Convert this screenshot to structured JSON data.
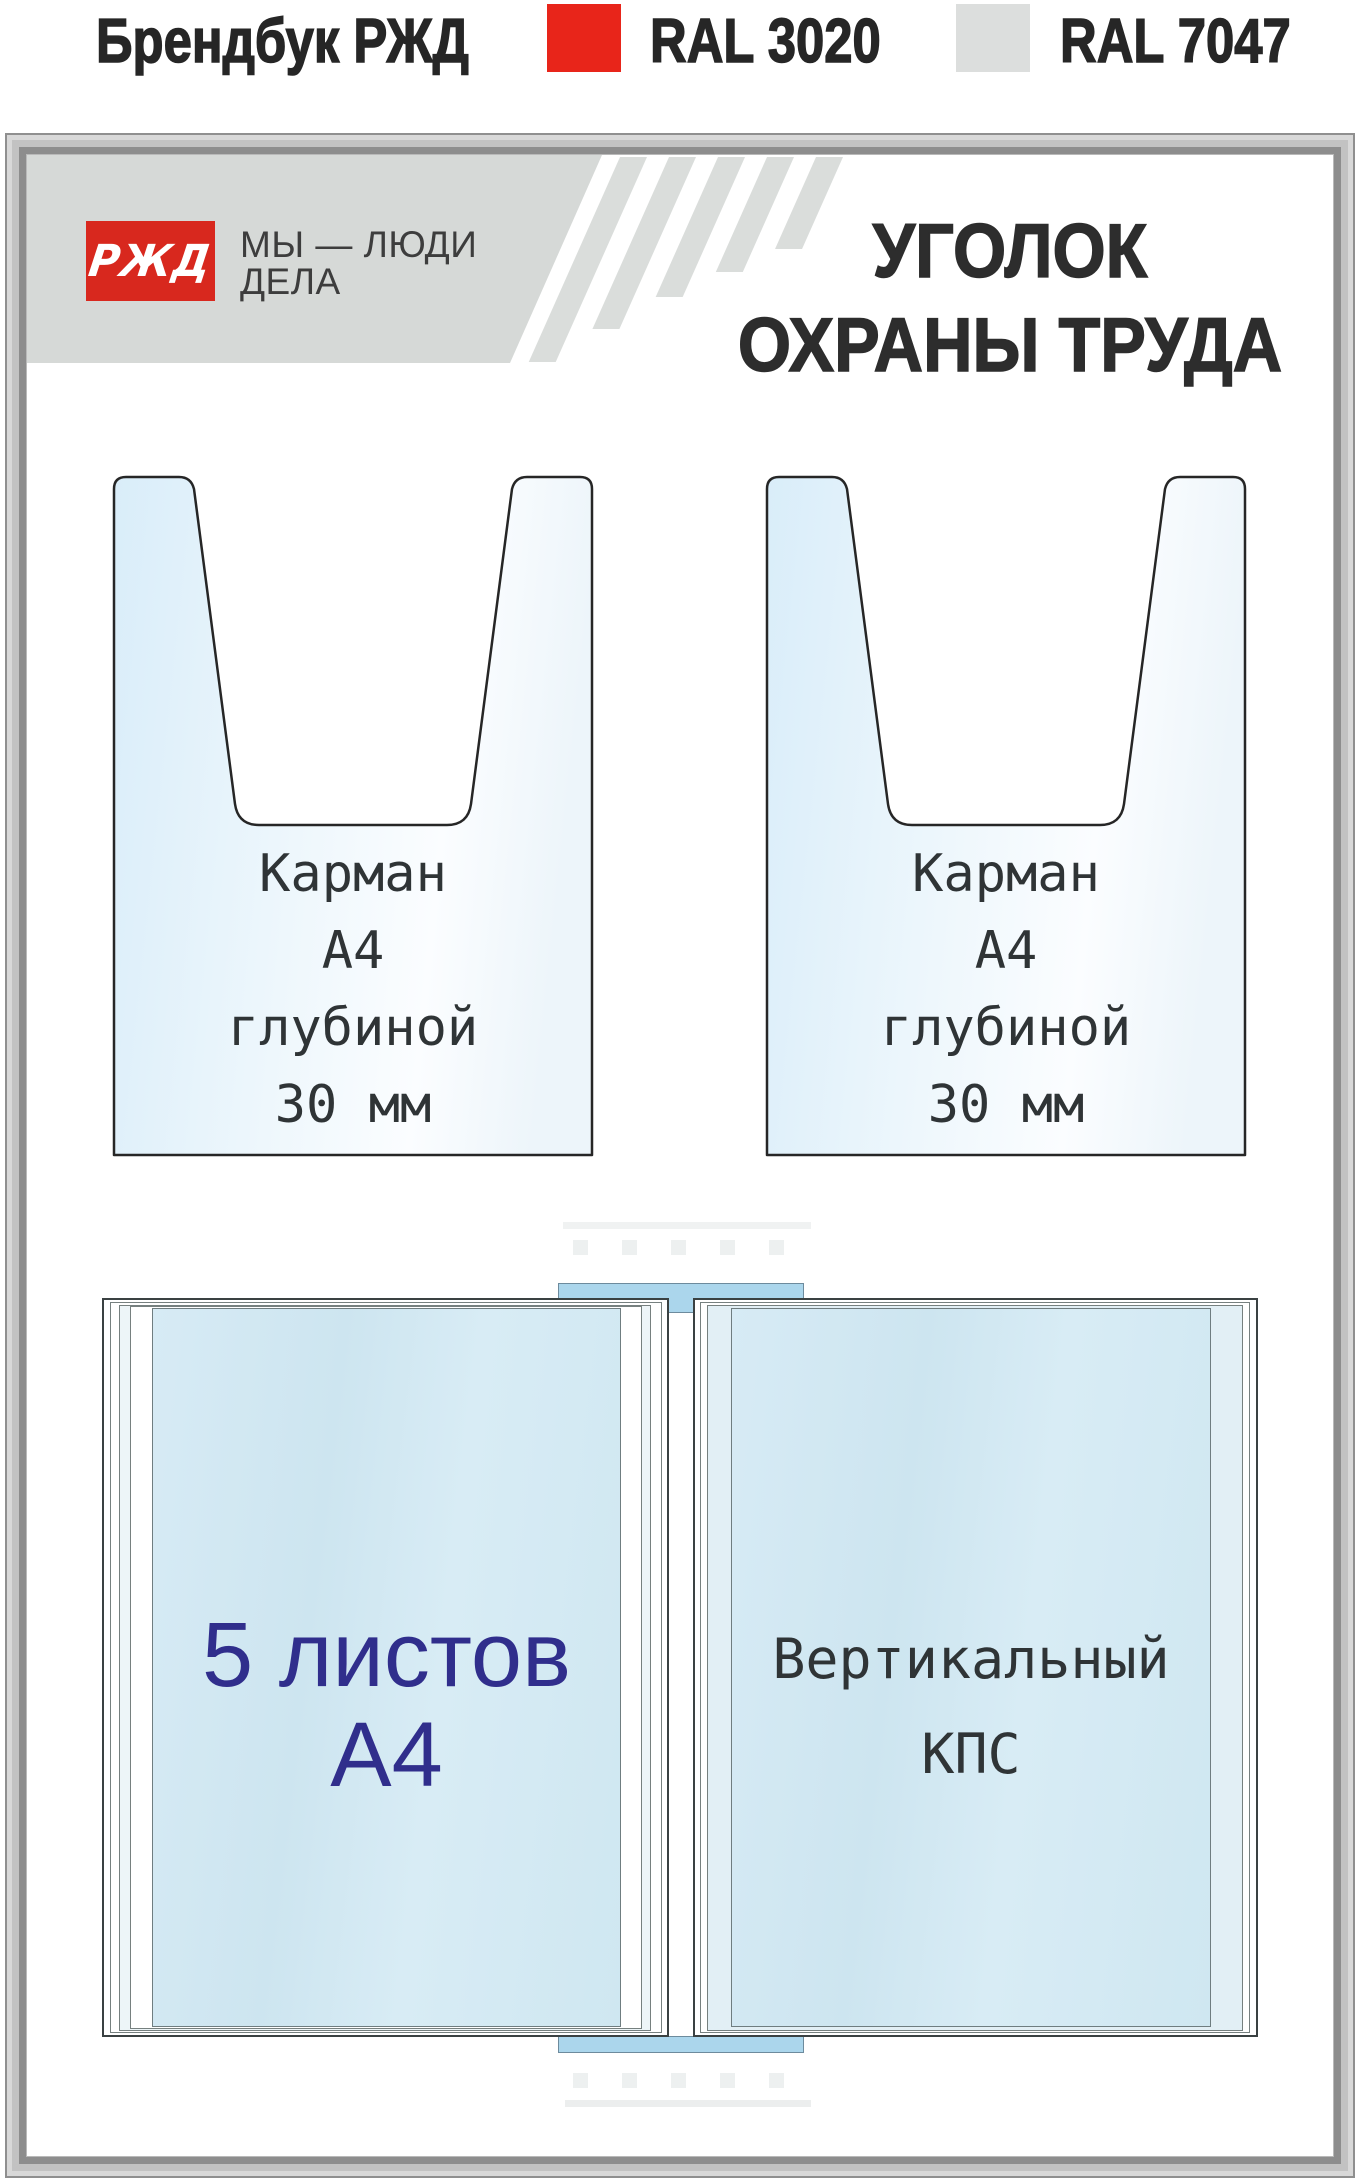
{
  "header": {
    "brand": "Брендбук РЖД",
    "swatches": [
      {
        "label": "RAL 3020",
        "color": "#e8251a"
      },
      {
        "label": "RAL 7047",
        "color": "#dcdedd"
      }
    ]
  },
  "board": {
    "logo": {
      "text": "РЖД",
      "bg": "#d8281e"
    },
    "tagline_line1": "МЫ — ЛЮДИ",
    "tagline_line2": "ДЕЛА",
    "title_line1": "УГОЛОК",
    "title_line2": "ОХРАНЫ ТРУДА",
    "band_color": "#d6d9d7",
    "pockets": [
      {
        "lines": [
          "Карман",
          "А4",
          "глубиной",
          "30 мм"
        ]
      },
      {
        "lines": [
          "Карман",
          "А4",
          "глубиной",
          "30 мм"
        ]
      }
    ],
    "flip_system": {
      "left_panel_line1": "5 листов",
      "left_panel_line2": "А4",
      "right_panel_line1": "Вертикальный",
      "right_panel_line2": "КПС",
      "tab_color": "#abd6ec",
      "left_text_color": "#302e8c"
    }
  }
}
